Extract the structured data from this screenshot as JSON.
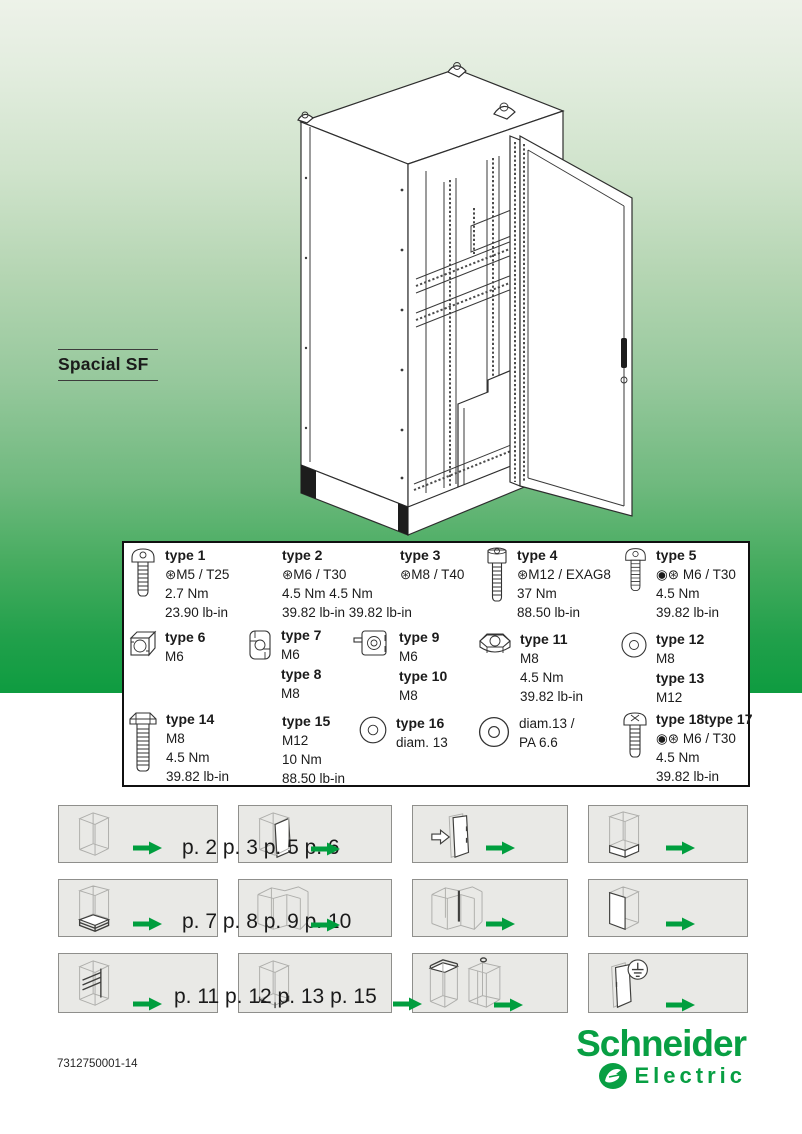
{
  "page": {
    "title": "Spacial SF",
    "doc_number": "7312750001-14"
  },
  "brand": {
    "line1": "Schneider",
    "line2": "Electric",
    "green": "#089F43"
  },
  "colors": {
    "arrow_green": "#009E3E",
    "gradient_top": "#EDF2E9",
    "gradient_bottom": "#0E9C40",
    "panel_bg": "#E9E9E6",
    "table_border": "#101010"
  },
  "fastener_table": {
    "rows": [
      {
        "cells": [
          {
            "icon": "pan-head-torx-screw-icon",
            "entries": [
              {
                "title": "type 1",
                "lines": [
                  "⊛M5 / T25",
                  "2.7 Nm",
                  "23.90 lb-in"
                ]
              }
            ]
          },
          {
            "icon": null,
            "entries": [
              {
                "title": "type 2",
                "lines": [
                  "⊛M6 / T30",
                  "4.5 Nm 4.5 Nm",
                  "39.82 lb-in 39.82 lb-in"
                ]
              }
            ]
          },
          {
            "icon": null,
            "entries": [
              {
                "title": "type 3",
                "lines": [
                  "⊛M8 / T40"
                ]
              }
            ]
          },
          {
            "icon": "socket-head-screw-icon",
            "entries": [
              {
                "title": "type 4",
                "lines": [
                  "⊛M12 / EXAG8",
                  "37 Nm",
                  "88.50 lb-in"
                ]
              }
            ]
          },
          {
            "icon": "pan-head-torx-screw-icon",
            "entries": [
              {
                "title": "type 5",
                "lines": [
                  "◉⊛ M6 / T30",
                  "4.5 Nm",
                  "39.82 lb-in"
                ]
              }
            ]
          }
        ]
      },
      {
        "cells": [
          {
            "icon": "cage-nut-icon",
            "entries": [
              {
                "title": "type 6",
                "lines": [
                  "M6"
                ]
              }
            ]
          },
          {
            "icon": "clip-nut-icon",
            "entries": [
              {
                "title": "type 7",
                "lines": [
                  "M6"
                ]
              },
              {
                "title": "type 8",
                "lines": [
                  "M8"
                ]
              }
            ]
          },
          {
            "icon": "speed-clip-nut-icon",
            "entries": [
              {
                "title": "type 9",
                "lines": [
                  "M6"
                ]
              },
              {
                "title": "type 10",
                "lines": [
                  "M8"
                ]
              }
            ]
          },
          {
            "icon": "hex-nut-icon",
            "entries": [
              {
                "title": "type 11",
                "lines": [
                  "M8",
                  "4.5 Nm",
                  "39.82 lb-in"
                ]
              }
            ]
          },
          {
            "icon": "washer-icon",
            "entries": [
              {
                "title": "type 12",
                "lines": [
                  "M8"
                ]
              },
              {
                "title": "type 13",
                "lines": [
                  "M12"
                ]
              }
            ]
          }
        ]
      },
      {
        "cells": [
          {
            "icon": "hex-bolt-icon",
            "entries": [
              {
                "title": "type 14",
                "lines": [
                  "M8",
                  "4.5 Nm",
                  "39.82 lb-in"
                ]
              }
            ]
          },
          {
            "icon": null,
            "entries": [
              {
                "title": "type 15",
                "lines": [
                  "M12",
                  "10 Nm",
                  "88.50 lb-in"
                ]
              }
            ]
          },
          {
            "icon": "washer-icon",
            "entries": [
              {
                "title": "type 16",
                "lines": [
                  "diam. 13"
                ]
              }
            ]
          },
          {
            "icon": "washer-icon",
            "entries": [
              {
                "title": "",
                "lines": [
                  "diam.13 /",
                  "PA 6.6"
                ]
              }
            ]
          },
          {
            "icon": "pozi-torx-screw-icon",
            "entries": [
              {
                "title": "type 18type 17",
                "lines": [
                  "◉⊛ M6 / T30",
                  "4.5 Nm",
                  "39.82 lb-in"
                ]
              }
            ]
          }
        ]
      }
    ]
  },
  "panel_rows": [
    {
      "labels": "p. 2 p. 3 p. 5 p. 6",
      "panels": [
        {
          "illustration": "frame-cabinet"
        },
        {
          "illustration": "cabinet-open-door"
        },
        {
          "illustration": "door-mounting"
        },
        {
          "illustration": "cabinet-plinth"
        }
      ]
    },
    {
      "labels": "p. 7 p. 8 p. 9 p. 10",
      "panels": [
        {
          "illustration": "cabinet-base-plates"
        },
        {
          "illustration": "bayed-cabinets"
        },
        {
          "illustration": "bayed-cabinets-joining"
        },
        {
          "illustration": "cabinet-side-panel"
        }
      ]
    },
    {
      "labels": "p. 11 p. 12 p. 13 p. 15",
      "panels": [
        {
          "illustration": "cabinet-interior-rails"
        },
        {
          "illustration": "cabinet-corner-trims"
        },
        {
          "illustration": "roof-plate-cabinets"
        },
        {
          "illustration": "door-grounding"
        }
      ]
    }
  ]
}
